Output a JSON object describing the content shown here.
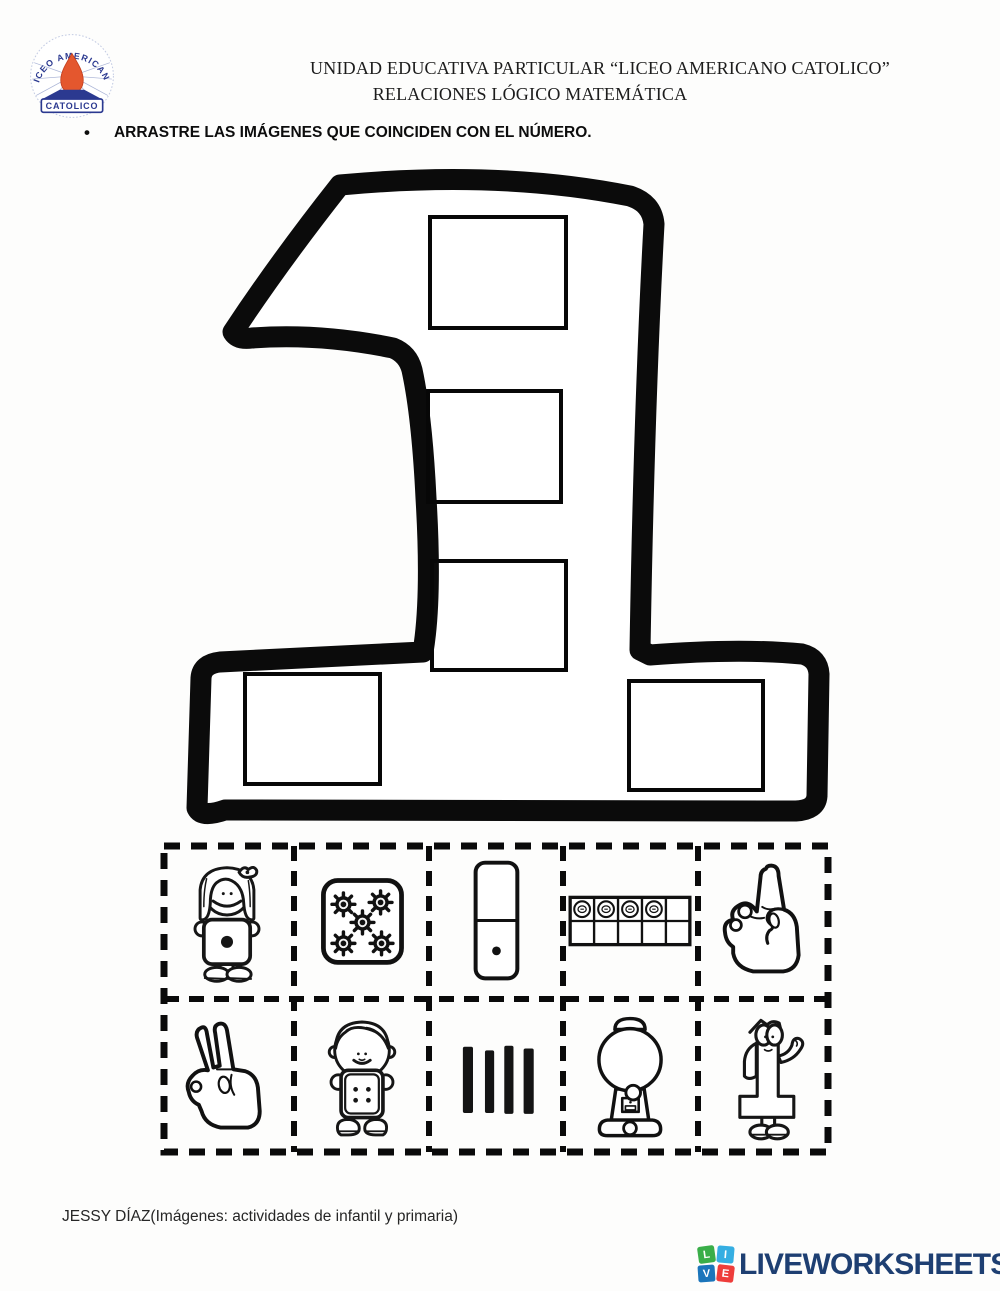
{
  "header": {
    "line1": "UNIDAD EDUCATIVA PARTICULAR “LICEO AMERICANO CATOLICO”",
    "line2": "RELACIONES LÓGICO MATEMÁTICA",
    "logo": {
      "arc_text": "LICEO AMERICANO",
      "banner_text": "CATOLICO",
      "drop_color": "#e4572e",
      "navy": "#2b3990"
    }
  },
  "instruction": {
    "bullet": "•",
    "text": "ARRASTRE LAS IMÁGENES QUE COINCIDEN CON EL NÚMERO."
  },
  "number_zone": {
    "target_number": "1",
    "outline_color": "#0b0b0b",
    "drop_zone_count": 5,
    "drop_zones": [
      "zone-1-top",
      "zone-2-middle",
      "zone-3-lower",
      "zone-4-base-left",
      "zone-5-base-right"
    ]
  },
  "cards": [
    {
      "id": "girl-one-dot",
      "icon": "girl-holding-card-one-dot-icon",
      "label": "niña con tarjeta de 1 punto",
      "value": 1
    },
    {
      "id": "die-five-gears",
      "icon": "card-with-five-gear-dots-icon",
      "label": "tarjeta con 5 engranajes",
      "value": 5
    },
    {
      "id": "domino-one",
      "icon": "domino-one-dot-icon",
      "label": "dominó con 1 punto",
      "value": 1
    },
    {
      "id": "ten-frame-four",
      "icon": "ten-frame-four-coins-icon",
      "label": "cuadro de diez con 4 fichas",
      "value": 4
    },
    {
      "id": "hand-one-finger",
      "icon": "hand-showing-one-finger-icon",
      "label": "mano mostrando 1 dedo",
      "value": 1
    },
    {
      "id": "hand-two-fingers",
      "icon": "hand-showing-two-fingers-icon",
      "label": "mano mostrando 2 dedos",
      "value": 2
    },
    {
      "id": "boy-four-dots",
      "icon": "boy-holding-card-four-dots-icon",
      "label": "niño con tarjeta de 4 puntos",
      "value": 4
    },
    {
      "id": "four-bars",
      "icon": "four-tally-bars-icon",
      "label": "4 barras verticales",
      "value": 4
    },
    {
      "id": "gumball-machine",
      "icon": "gumball-machine-icon",
      "label": "máquina de chicles",
      "value": 1
    },
    {
      "id": "number-one-character",
      "icon": "number-one-character-icon",
      "label": "número 1 con cara",
      "value": 1
    }
  ],
  "footer": {
    "credit": "JESSY DÍAZ(Imágenes: actividades de infantil y primaria)"
  },
  "brand": {
    "wordmark": "LIVEWORKSHEETS",
    "navy": "#1e3f72",
    "tiles": [
      {
        "letter": "L",
        "color": "#3aae49"
      },
      {
        "letter": "I",
        "color": "#35aee2"
      },
      {
        "letter": "V",
        "color": "#1b75bb"
      },
      {
        "letter": "E",
        "color": "#ee3d3b"
      }
    ]
  }
}
